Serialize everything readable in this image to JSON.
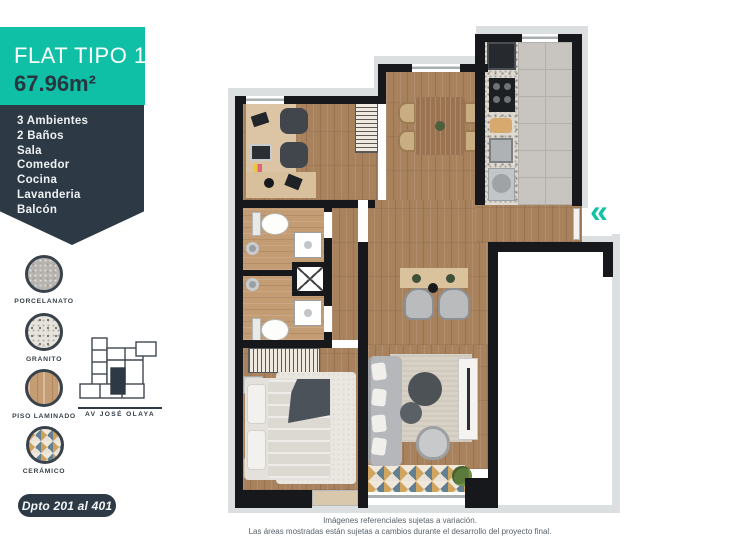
{
  "header": {
    "title": "FLAT TIPO 1",
    "area": "67.96m²"
  },
  "features": [
    "3 Ambientes",
    "2 Baños",
    "Sala",
    "Comedor",
    "Cocina",
    "Lavanderia",
    "Balcón"
  ],
  "materials": [
    {
      "label": "PORCELANATO"
    },
    {
      "label": "GRANITO"
    },
    {
      "label": "PISO LAMINADO"
    },
    {
      "label": "CERÁMICO"
    }
  ],
  "location": {
    "street_label": "AV  JOSÉ OLAYA"
  },
  "badge": {
    "label": "Dpto 201 al 401"
  },
  "plan": {
    "entrance_icon": "«"
  },
  "disclaimer": {
    "line1": "Imágenes referenciales sujetas a variación.",
    "line2": "Las áreas mostradas están sujetas a cambios durante el desarrollo del proyecto final."
  },
  "colors": {
    "teal": "#0fbfa6",
    "navy": "#2d3a45",
    "chevron": "#0fc3a7"
  }
}
